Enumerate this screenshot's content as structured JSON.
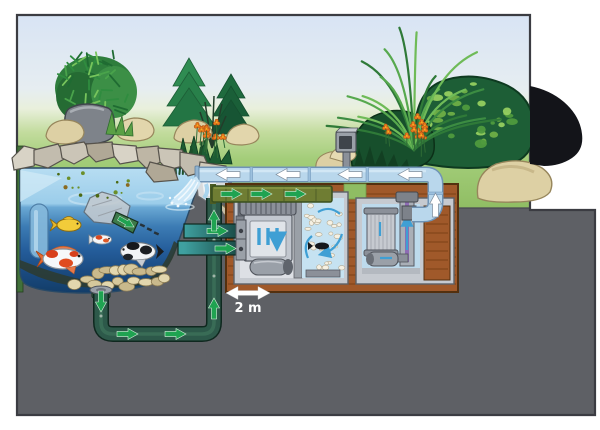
{
  "illustration": {
    "name": "pond-filtration-system-cutaway",
    "distance_label": "2 m"
  },
  "icons": {
    "return-flow-arrow": "◀",
    "suction-flow-arrow": "▶",
    "chamber-circulation-arrow": "↻",
    "distance-double-arrow": "↔"
  },
  "colors": {
    "sky": "#d8e4f4",
    "grass": "#8fbd63",
    "underground": "#5e6065",
    "pond_surface": "#b7ddf2",
    "pond_deep": "#123c66",
    "return_pipe": "#b9d7ec",
    "drain_pipe": "#2d594a",
    "flow_arrow_green": "#1fa351",
    "flow_arrow_white": "#ffffff",
    "chamber_arrow_blue": "#3f9fd4",
    "vault_wood": "#a0592a",
    "uv_lamp": "#8e6cb4",
    "flowers": "#e87a1e"
  }
}
